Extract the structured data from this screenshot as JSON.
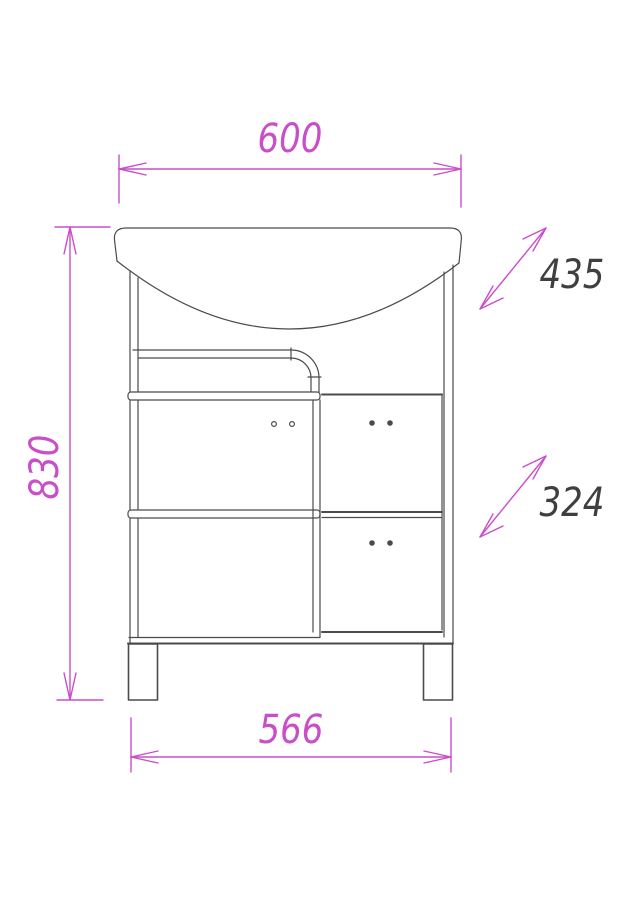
{
  "drawing": {
    "subject": "bathroom-vanity-with-sink-front-elevation",
    "colors": {
      "dimension_accent": "#c94fc9",
      "drawing_line": "#4b4b4b",
      "diagonal_label_text": "#3f3f3f",
      "background": "#ffffff"
    },
    "dimensions": {
      "top_width": "600",
      "height": "830",
      "sink_depth": "435",
      "cabinet_depth": "324",
      "base_width": "566"
    }
  }
}
